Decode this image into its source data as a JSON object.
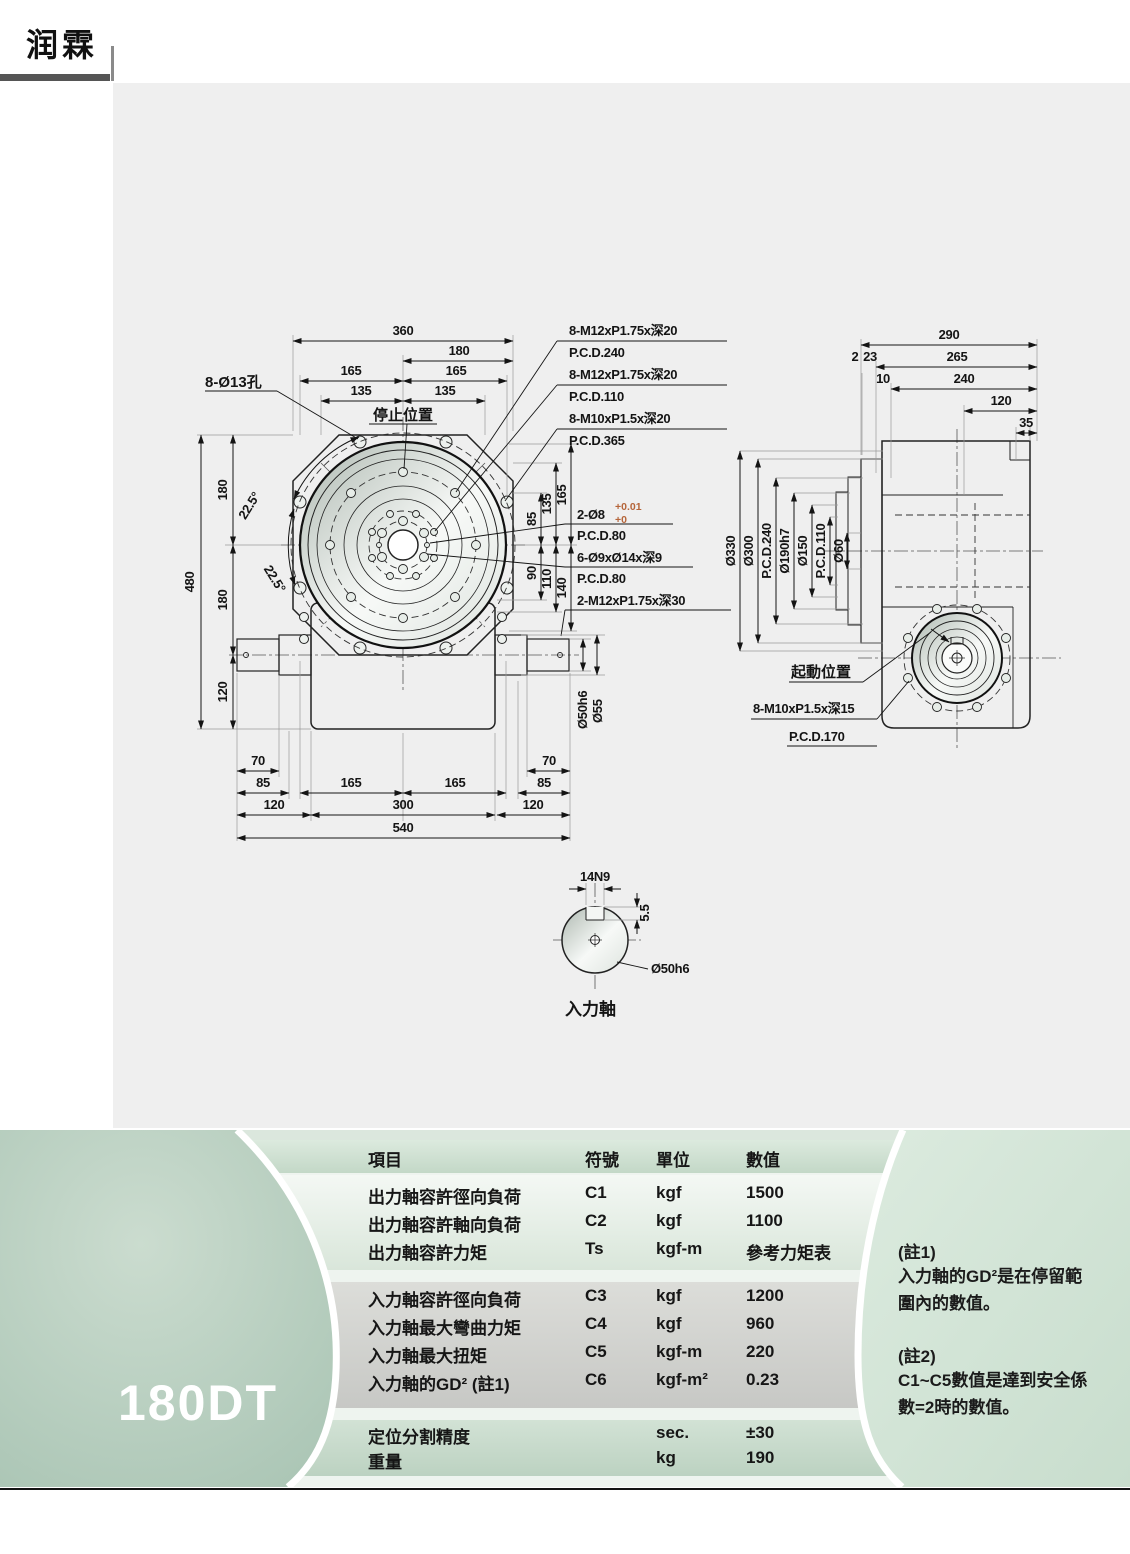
{
  "logo": {
    "text": "润霖"
  },
  "badge": {
    "label": "180DT"
  },
  "front_view": {
    "stop_label": "停止位置",
    "holes_label": "8-Ø13孔",
    "top_dims": [
      "360",
      "180",
      "165",
      "165",
      "135",
      "135"
    ],
    "left_dims": [
      "480",
      "180",
      "180",
      "120"
    ],
    "angles": [
      "22.5°",
      "22.5°"
    ],
    "right_dims": [
      "85",
      "135",
      "165",
      "90",
      "110",
      "140"
    ],
    "leaders": [
      {
        "l1": "8-M12xP1.75x深20",
        "l2": "P.C.D.240"
      },
      {
        "l1": "8-M12xP1.75x深20",
        "l2": "P.C.D.110"
      },
      {
        "l1": "8-M10xP1.5x深20",
        "l2": "P.C.D.365"
      },
      {
        "l1": "2-Ø8",
        "sup": "+0.01",
        "sub": "+0",
        "l2": "P.C.D.80"
      },
      {
        "l1": "6-Ø9xØ14x深9",
        "l2": "P.C.D.80"
      },
      {
        "l1": "2-M12xP1.75x深30",
        "l2": ""
      }
    ],
    "bottom_dims": [
      "70",
      "85",
      "120",
      "165",
      "165",
      "300",
      "120",
      "70",
      "85",
      "540"
    ],
    "shaft_dims": [
      "Ø50h6",
      "Ø55"
    ]
  },
  "side_view": {
    "top_dims": [
      "290",
      "2",
      "23",
      "265",
      "10",
      "240",
      "120",
      "35"
    ],
    "dia_labels": [
      "Ø330",
      "Ø300",
      "P.C.D.240",
      "Ø190h7",
      "Ø150",
      "P.C.D.110",
      "Ø60"
    ],
    "start_label": "起動位置",
    "bolt_label": {
      "l1": "8-M10xP1.5x深15",
      "l2": "P.C.D.170"
    }
  },
  "input_detail": {
    "key_width": "14N9",
    "key_depth": "5.5",
    "shaft_dia": "Ø50h6",
    "caption": "入力軸"
  },
  "spec_table": {
    "headers": [
      "項目",
      "符號",
      "單位",
      "數值"
    ],
    "rows": [
      {
        "item": "出力軸容許徑向負荷",
        "symbol": "C1",
        "unit": "kgf",
        "value": "1500"
      },
      {
        "item": "出力軸容許軸向負荷",
        "symbol": "C2",
        "unit": "kgf",
        "value": "1100"
      },
      {
        "item": "出力軸容許力矩",
        "symbol": "Ts",
        "unit": "kgf-m",
        "value": "參考力矩表"
      },
      {
        "item": "入力軸容許徑向負荷",
        "symbol": "C3",
        "unit": "kgf",
        "value": "1200"
      },
      {
        "item": "入力軸最大彎曲力矩",
        "symbol": "C4",
        "unit": "kgf",
        "value": "960"
      },
      {
        "item": "入力軸最大扭矩",
        "symbol": "C5",
        "unit": "kgf-m",
        "value": "220"
      },
      {
        "item": "入力軸的GD² (註1)",
        "symbol": "C6",
        "unit": "kgf-m²",
        "value": "0.23"
      },
      {
        "item": "定位分割精度",
        "symbol": "",
        "unit": "sec.",
        "value": "±30"
      },
      {
        "item": "重量",
        "symbol": "",
        "unit": "kg",
        "value": "190"
      }
    ]
  },
  "notes": {
    "note1_title": "(註1)",
    "note1_body": "入力軸的GD²是在停留範圍內的數值。",
    "note2_title": "(註2)",
    "note2_body": "C1~C5數值是達到安全係數=2時的數值。"
  },
  "footer_model": "180DT"
}
